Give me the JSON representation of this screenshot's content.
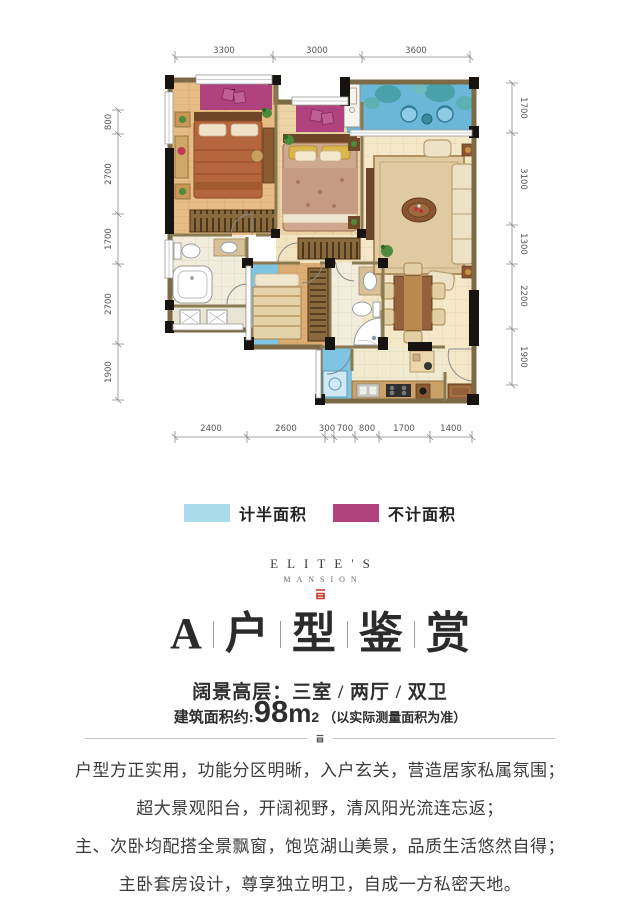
{
  "plan": {
    "dims_top": [
      "3300",
      "3000",
      "3600"
    ],
    "dims_left": [
      "800",
      "2700",
      "1700",
      "2700",
      "1900"
    ],
    "dims_right": [
      "1700",
      "3100",
      "1300",
      "2200",
      "1900"
    ],
    "dims_bottom": [
      "2400",
      "2600",
      "300",
      "700",
      "800",
      "1700",
      "1400"
    ]
  },
  "legend": {
    "items": [
      {
        "label": "计半面积",
        "color": "#aadcee"
      },
      {
        "label": "不计面积",
        "color": "#b0437f"
      }
    ]
  },
  "brand": {
    "line1": "ELITE'S",
    "line2": "MANSION"
  },
  "title": {
    "chars": [
      "A",
      "户",
      "型",
      "鉴",
      "赏"
    ]
  },
  "subtitle": "阔景高层：三室 / 两厅 / 双卫",
  "area": {
    "prefix": "建筑面积约:",
    "value": "98",
    "unit": "m",
    "sup": "2",
    "note": "（以实际测量面积为准）"
  },
  "paragraphs": [
    "户型方正实用，功能分区明晰，入户玄关，营造居家私属氛围；",
    "超大景观阳台，开阔视野，清风阳光流连忘返；",
    "主、次卧均配搭全景飘窗，饱览湖山美景，品质生活悠然自得；",
    "主卧套房设计，尊享独立明卫，自成一方私密天地。"
  ],
  "colors": {
    "bay_magenta": "#b0437f",
    "balcony_blue": "#6bb7d7",
    "half_area_blue": "#7fc4e0",
    "wall_dark": "#171310",
    "wall_tan": "#7b6a45",
    "brand_red": "#c23a33",
    "text_dark": "#3b3b3b"
  }
}
